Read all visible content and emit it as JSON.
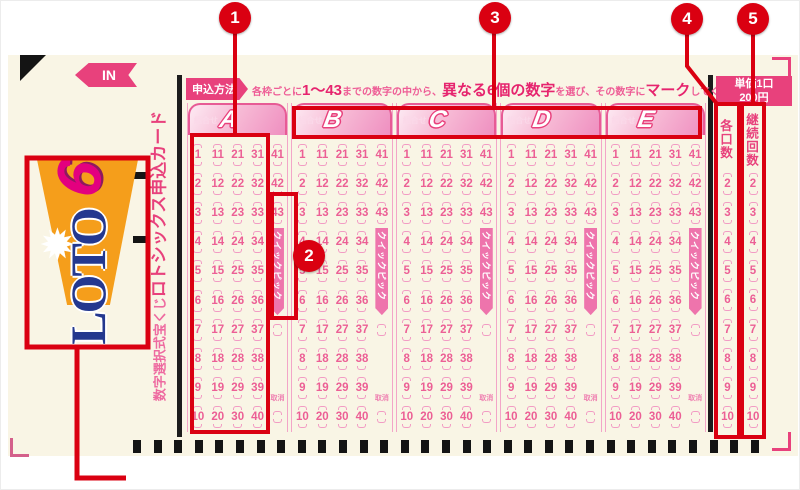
{
  "annotations": {
    "labels": [
      "1",
      "2",
      "3",
      "4",
      "5"
    ]
  },
  "ticket": {
    "in_arrow": "IN",
    "logo": {
      "text": "LOTO",
      "six": "6",
      "star_icon": "starburst"
    },
    "side_title": {
      "small": "数字選択式宝くじ",
      "large": "ロトシックス申込カード"
    },
    "instruction": {
      "badge": "申込方法",
      "segments": [
        {
          "text": "各枠ごとに",
          "em": false
        },
        {
          "text": "1〜43",
          "em": true
        },
        {
          "text": "までの数字の中から、",
          "em": false
        },
        {
          "text": "異なる6個の数字",
          "em": true
        },
        {
          "text": "を選び、その数字に",
          "em": false
        },
        {
          "text": "マーク",
          "em": true
        },
        {
          "text": "してください。",
          "em": false
        }
      ]
    },
    "price": {
      "line1": "単価1口",
      "line2": "200円"
    },
    "blocks": {
      "label": "組合せ",
      "letters": [
        "A",
        "B",
        "C",
        "D",
        "E"
      ],
      "columns": [
        [
          1,
          2,
          3,
          4,
          5,
          6,
          7,
          8,
          9,
          10
        ],
        [
          11,
          12,
          13,
          14,
          15,
          16,
          17,
          18,
          19,
          20
        ],
        [
          21,
          22,
          23,
          24,
          25,
          26,
          27,
          28,
          29,
          30
        ],
        [
          31,
          32,
          33,
          34,
          35,
          36,
          37,
          38,
          39,
          40
        ],
        [
          41,
          42,
          43
        ]
      ],
      "quickpick": "クイックピック",
      "cancel": "取消"
    },
    "right_columns": [
      {
        "header": "各口数",
        "values": [
          2,
          3,
          4,
          5,
          6,
          7,
          8,
          9,
          10
        ]
      },
      {
        "header": "継続回数",
        "values": [
          2,
          3,
          4,
          5,
          6,
          7,
          8,
          9,
          10
        ]
      }
    ]
  }
}
